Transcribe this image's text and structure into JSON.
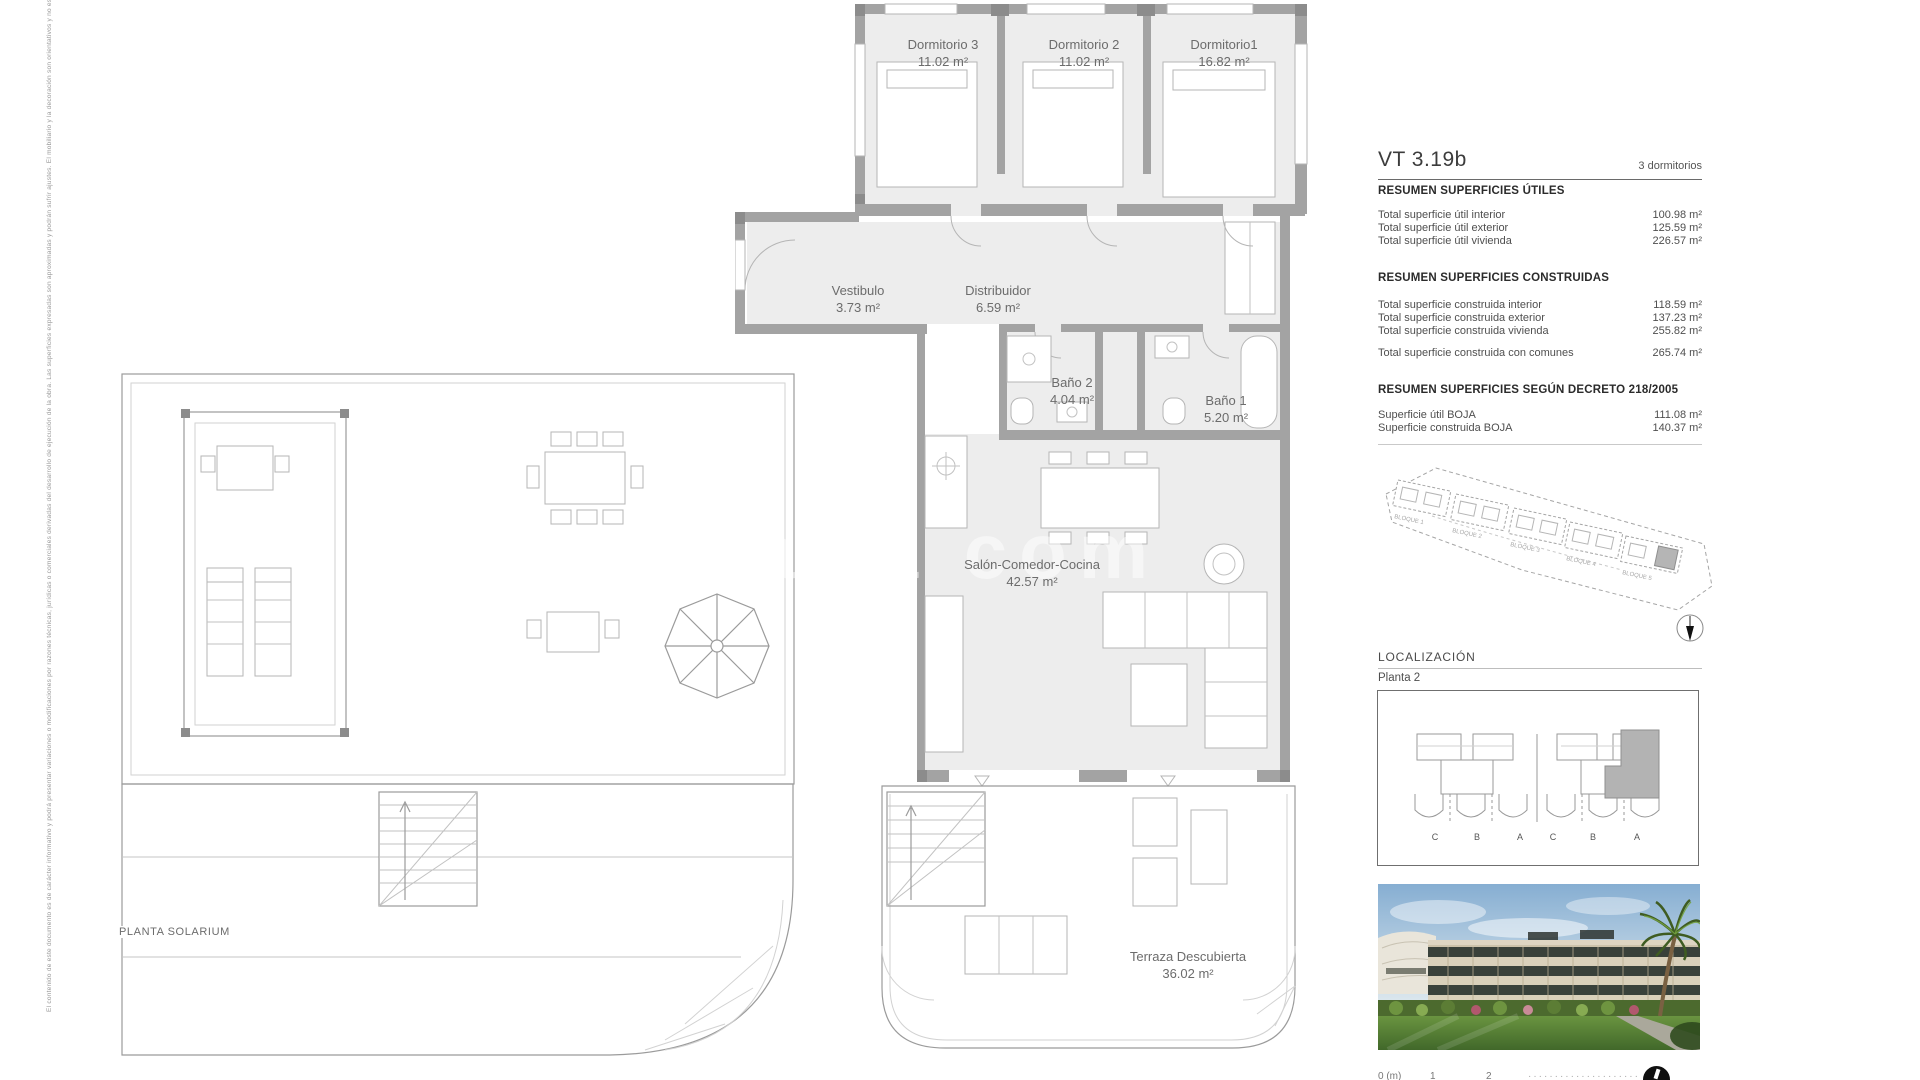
{
  "meta": {
    "disclaimer": "El contenido de este documento es de carácter informativo y podrá presentar variaciones o modificaciones por razones técnicas, jurídicas o comerciales derivadas del desarrollo de ejecución de la obra. Las superficies expresadas son aproximadas y podrán sufrir ajustes. El mobiliario y la decoración son orientativos y no están incluidos. Imágenes no contractuales."
  },
  "watermark": {
    "text": "alia com"
  },
  "unit": {
    "code": "VT 3.19b",
    "bedrooms_label": "3 dormitorios"
  },
  "summary_tables": [
    {
      "title": "RESUMEN SUPERFICIES ÚTILES",
      "rows": [
        {
          "label": "Total superficie útil interior",
          "value": "100.98 m²"
        },
        {
          "label": "Total superficie útil exterior",
          "value": "125.59 m²"
        },
        {
          "label": "Total superficie útil vivienda",
          "value": "226.57 m²"
        }
      ]
    },
    {
      "title": "RESUMEN SUPERFICIES CONSTRUIDAS",
      "rows": [
        {
          "label": "Total superficie construida interior",
          "value": "118.59 m²"
        },
        {
          "label": "Total superficie construida exterior",
          "value": "137.23 m²"
        },
        {
          "label": "Total superficie construida vivienda",
          "value": "255.82 m²"
        }
      ],
      "extra_row": {
        "label": "Total superficie construida con comunes",
        "value": "265.74 m²"
      }
    },
    {
      "title": "RESUMEN SUPERFICIES SEGÚN DECRETO 218/2005",
      "rows": [
        {
          "label": "Superficie útil BOJA",
          "value": "111.08 m²"
        },
        {
          "label": "Superficie construida BOJA",
          "value": "140.37 m²"
        }
      ]
    }
  ],
  "site_plan": {
    "blocks": [
      "BLOQUE 1",
      "BLOQUE 2",
      "BLOQUE 3",
      "BLOQUE 4",
      "BLOQUE 5"
    ]
  },
  "localization": {
    "heading": "LOCALIZACIÓN",
    "floor_label": "Planta 2",
    "letters": [
      "C",
      "B",
      "A",
      "C",
      "B",
      "A"
    ]
  },
  "floorplan": {
    "solarium_title": "PLANTA SOLARIUM",
    "rooms": [
      {
        "name": "Dormitorio 3",
        "area": "11.02 m²"
      },
      {
        "name": "Dormitorio 2",
        "area": "11.02 m²"
      },
      {
        "name": "Dormitorio1",
        "area": "16.82 m²"
      },
      {
        "name": "Vestibulo",
        "area": "3.73 m²"
      },
      {
        "name": "Distribuidor",
        "area": "6.59 m²"
      },
      {
        "name": "Baño 2",
        "area": "4.04 m²"
      },
      {
        "name": "Baño 1",
        "area": "5.20 m²"
      },
      {
        "name": "Salón-Comedor-Cocina",
        "area": "42.57 m²"
      },
      {
        "name": "Terraza Descubierta",
        "area": "36.02 m²"
      }
    ]
  },
  "scalebar": {
    "zero": "0 (m)",
    "one": "1",
    "two": "2",
    "dots": "·····················"
  },
  "colors": {
    "wall": "#a3a3a3",
    "floor": "#ededed",
    "highlight_unit": "#b3b3b3",
    "text": "#4f4f4f"
  }
}
